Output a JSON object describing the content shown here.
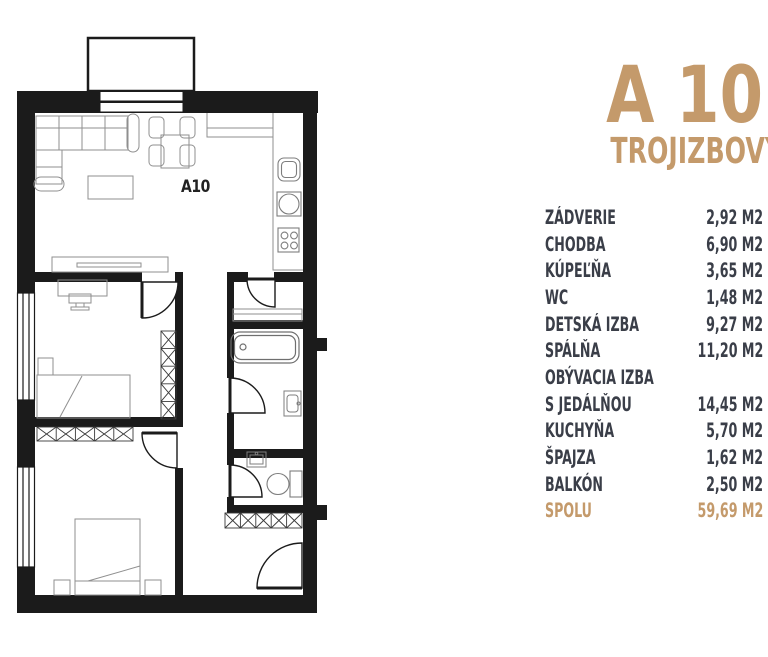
{
  "header": {
    "title": "A 10",
    "subtitle": "TROJIZBOVÝ APARTMÁN"
  },
  "plan": {
    "unit_label": "A10"
  },
  "room_table": {
    "rows": [
      {
        "label": "ZÁDVERIE",
        "area": "2,92 M2"
      },
      {
        "label": "CHODBA",
        "area": "6,90 M2"
      },
      {
        "label": "KÚPEĽŇA",
        "area": "3,65 M2"
      },
      {
        "label": "WC",
        "area": "1,48 M2"
      },
      {
        "label": "DETSKÁ IZBA",
        "area": "9,27 M2"
      },
      {
        "label": "SPÁLŇA",
        "area": "11,20 M2"
      },
      {
        "label": "OBÝVACIA IZBA",
        "area": ""
      },
      {
        "label": "S JEDÁLŇOU",
        "area": "14,45 M2"
      },
      {
        "label": "KUCHYŇA",
        "area": "5,70 M2"
      },
      {
        "label": "ŠPAJZA",
        "area": "1,62 M2"
      },
      {
        "label": "BALKÓN",
        "area": "2,50 M2"
      }
    ],
    "total": {
      "label": "SPOLU",
      "area": "59,69 M2"
    }
  },
  "colors": {
    "accent": "#C49A6B",
    "text": "#3A3E48",
    "walls": "#1B1B1B"
  }
}
